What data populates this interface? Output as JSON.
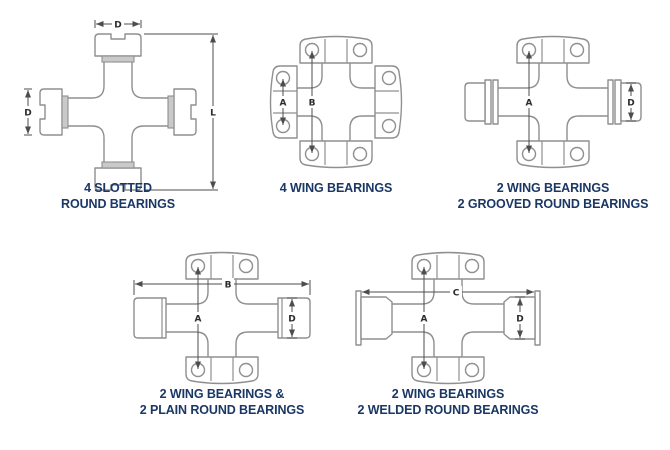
{
  "page": {
    "background": "#ffffff",
    "caption_color": "#1a3766",
    "line_color": "#8f8f8f",
    "dimension_color": "#4d4d4d",
    "shade_color": "#c9c9c9"
  },
  "figures": [
    {
      "name": "4-slotted-round-bearings",
      "caption": [
        "4 SLOTTED",
        "ROUND BEARINGS"
      ],
      "dims": {
        "top_width": "D",
        "side_diameter": "D",
        "overall_length": "L"
      }
    },
    {
      "name": "4-wing-bearings",
      "caption": [
        "4 WING BEARINGS"
      ],
      "dims": {
        "side_span": "A",
        "vertical_span": "B"
      }
    },
    {
      "name": "2-wing-2-grooved-round-bearings",
      "caption": [
        "2 WING BEARINGS",
        "2 GROOVED ROUND BEARINGS"
      ],
      "dims": {
        "hole_span": "A",
        "cup_diameter": "D"
      }
    },
    {
      "name": "2-wing-2-plain-round-bearings",
      "caption": [
        "2 WING BEARINGS &",
        "2 PLAIN ROUND BEARINGS"
      ],
      "dims": {
        "overall_width": "B",
        "hole_span": "A",
        "cup_diameter": "D"
      }
    },
    {
      "name": "2-wing-2-welded-round-bearings",
      "caption": [
        "2 WING BEARINGS",
        "2 WELDED ROUND BEARINGS"
      ],
      "dims": {
        "overall_width": "C",
        "hole_span": "A",
        "cup_diameter": "D"
      }
    }
  ]
}
